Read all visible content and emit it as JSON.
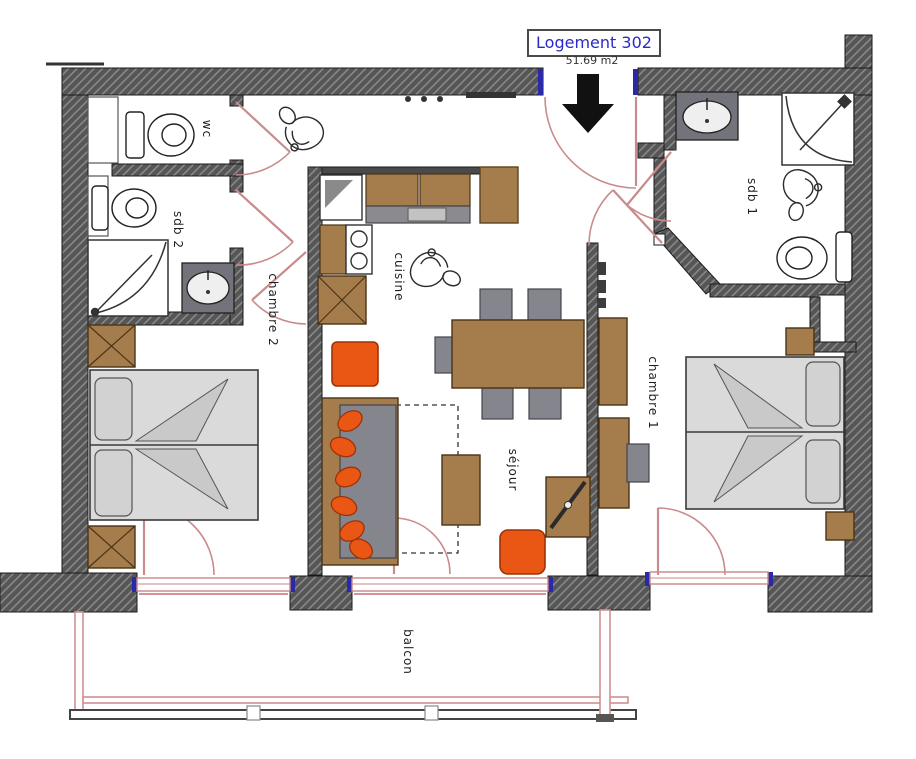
{
  "title": {
    "label": "Logement 302",
    "area": "51.69 m2"
  },
  "rooms": {
    "wc": {
      "label": "wc"
    },
    "sdb2": {
      "label": "sdb 2"
    },
    "chambre2": {
      "label": "chambre 2"
    },
    "cuisine": {
      "label": "cuisine"
    },
    "sejour": {
      "label": "séjour"
    },
    "chambre1": {
      "label": "chambre 1"
    },
    "sdb1": {
      "label": "sdb 1"
    },
    "balcon": {
      "label": "balcon"
    }
  },
  "colors": {
    "wall": "#565656",
    "wall_hatch": "#8f8f8f",
    "wood": "#a57c4c",
    "fixture_gray": "#84848c",
    "counter_dark": "#73737b",
    "bed_gray": "#dadada",
    "accent_orange": "#ea5715",
    "door_pink": "#c98b8b",
    "window_frame": "#c98585",
    "opening_cap_blue": "#2a2aa8",
    "title_text": "#2929c8"
  }
}
